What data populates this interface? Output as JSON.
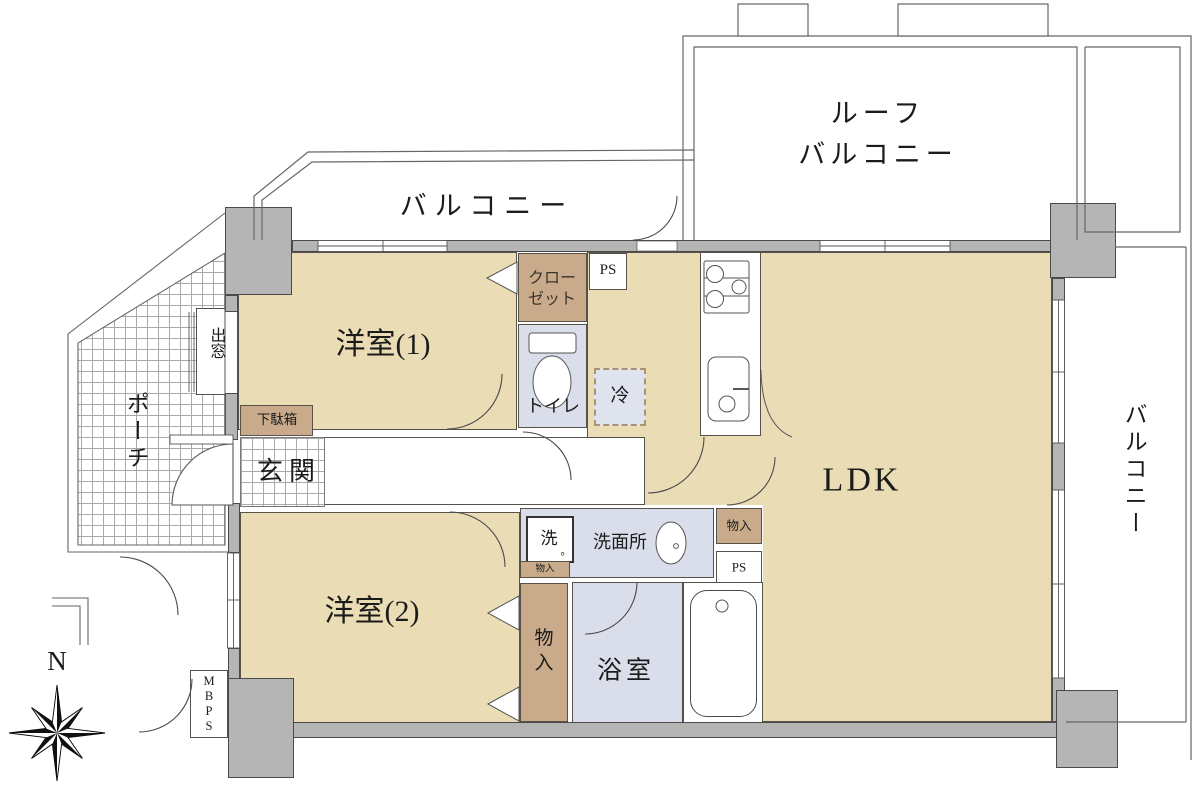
{
  "labels": {
    "balcony_top": "バルコニー",
    "roof_balcony": "ルーフ\nバルコニー",
    "western_room_1": "洋室(1)",
    "closet": "クロー\nゼット",
    "ps_top": "PS",
    "toilet": "トイレ",
    "refrigerator": "冷",
    "bay_window": "出窓",
    "porch": "ポーチ",
    "shoe_cabinet": "下駄箱",
    "entrance": "玄関",
    "ldk": "LDK",
    "balcony_right": "バルコニー",
    "washer": "洗",
    "washer_period": "。",
    "washroom": "洗面所",
    "storage_mini": "物入",
    "storage_ldk": "物入",
    "ps_mid": "PS",
    "western_room_2": "洋室(2)",
    "storage_closet": "物\n入",
    "bathroom": "浴室",
    "meter_box": "M\nB\nP\nS",
    "compass_north": "N"
  },
  "colors": {
    "room_floor": "#eaddb5",
    "closet_tan": "#c9ab8b",
    "wet_area": "#d9deea",
    "wall_gray": "#b5b5b5",
    "line": "#555555",
    "refrigerator_fill": "#dee3ee",
    "refrigerator_border": "#ab9371"
  }
}
